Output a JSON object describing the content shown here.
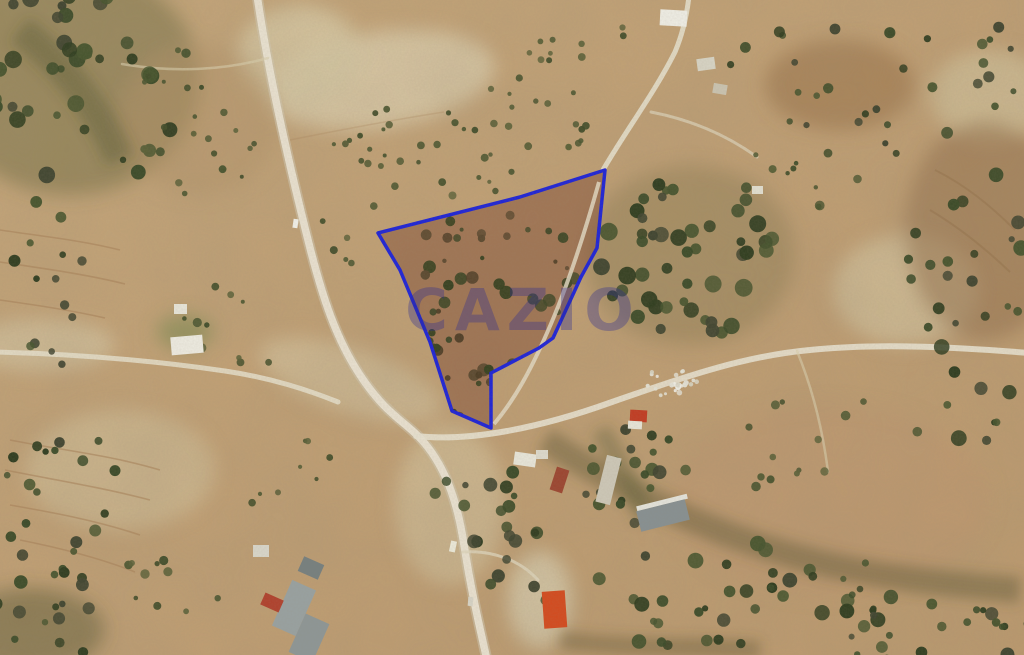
{
  "map": {
    "view": "satellite-aerial",
    "description": "Satellite view of rural terrain with a land parcel outlined",
    "watermark": {
      "text": "CAZIO",
      "color": "#2d2d91"
    },
    "parcel": {
      "outline_color": "#1c22d8",
      "fill_color": "#7a432e",
      "points": "378,233 520,197 605,170 597,248 581,277 553,338 539,348 491,373 491,428 452,411 430,342 400,270"
    }
  }
}
